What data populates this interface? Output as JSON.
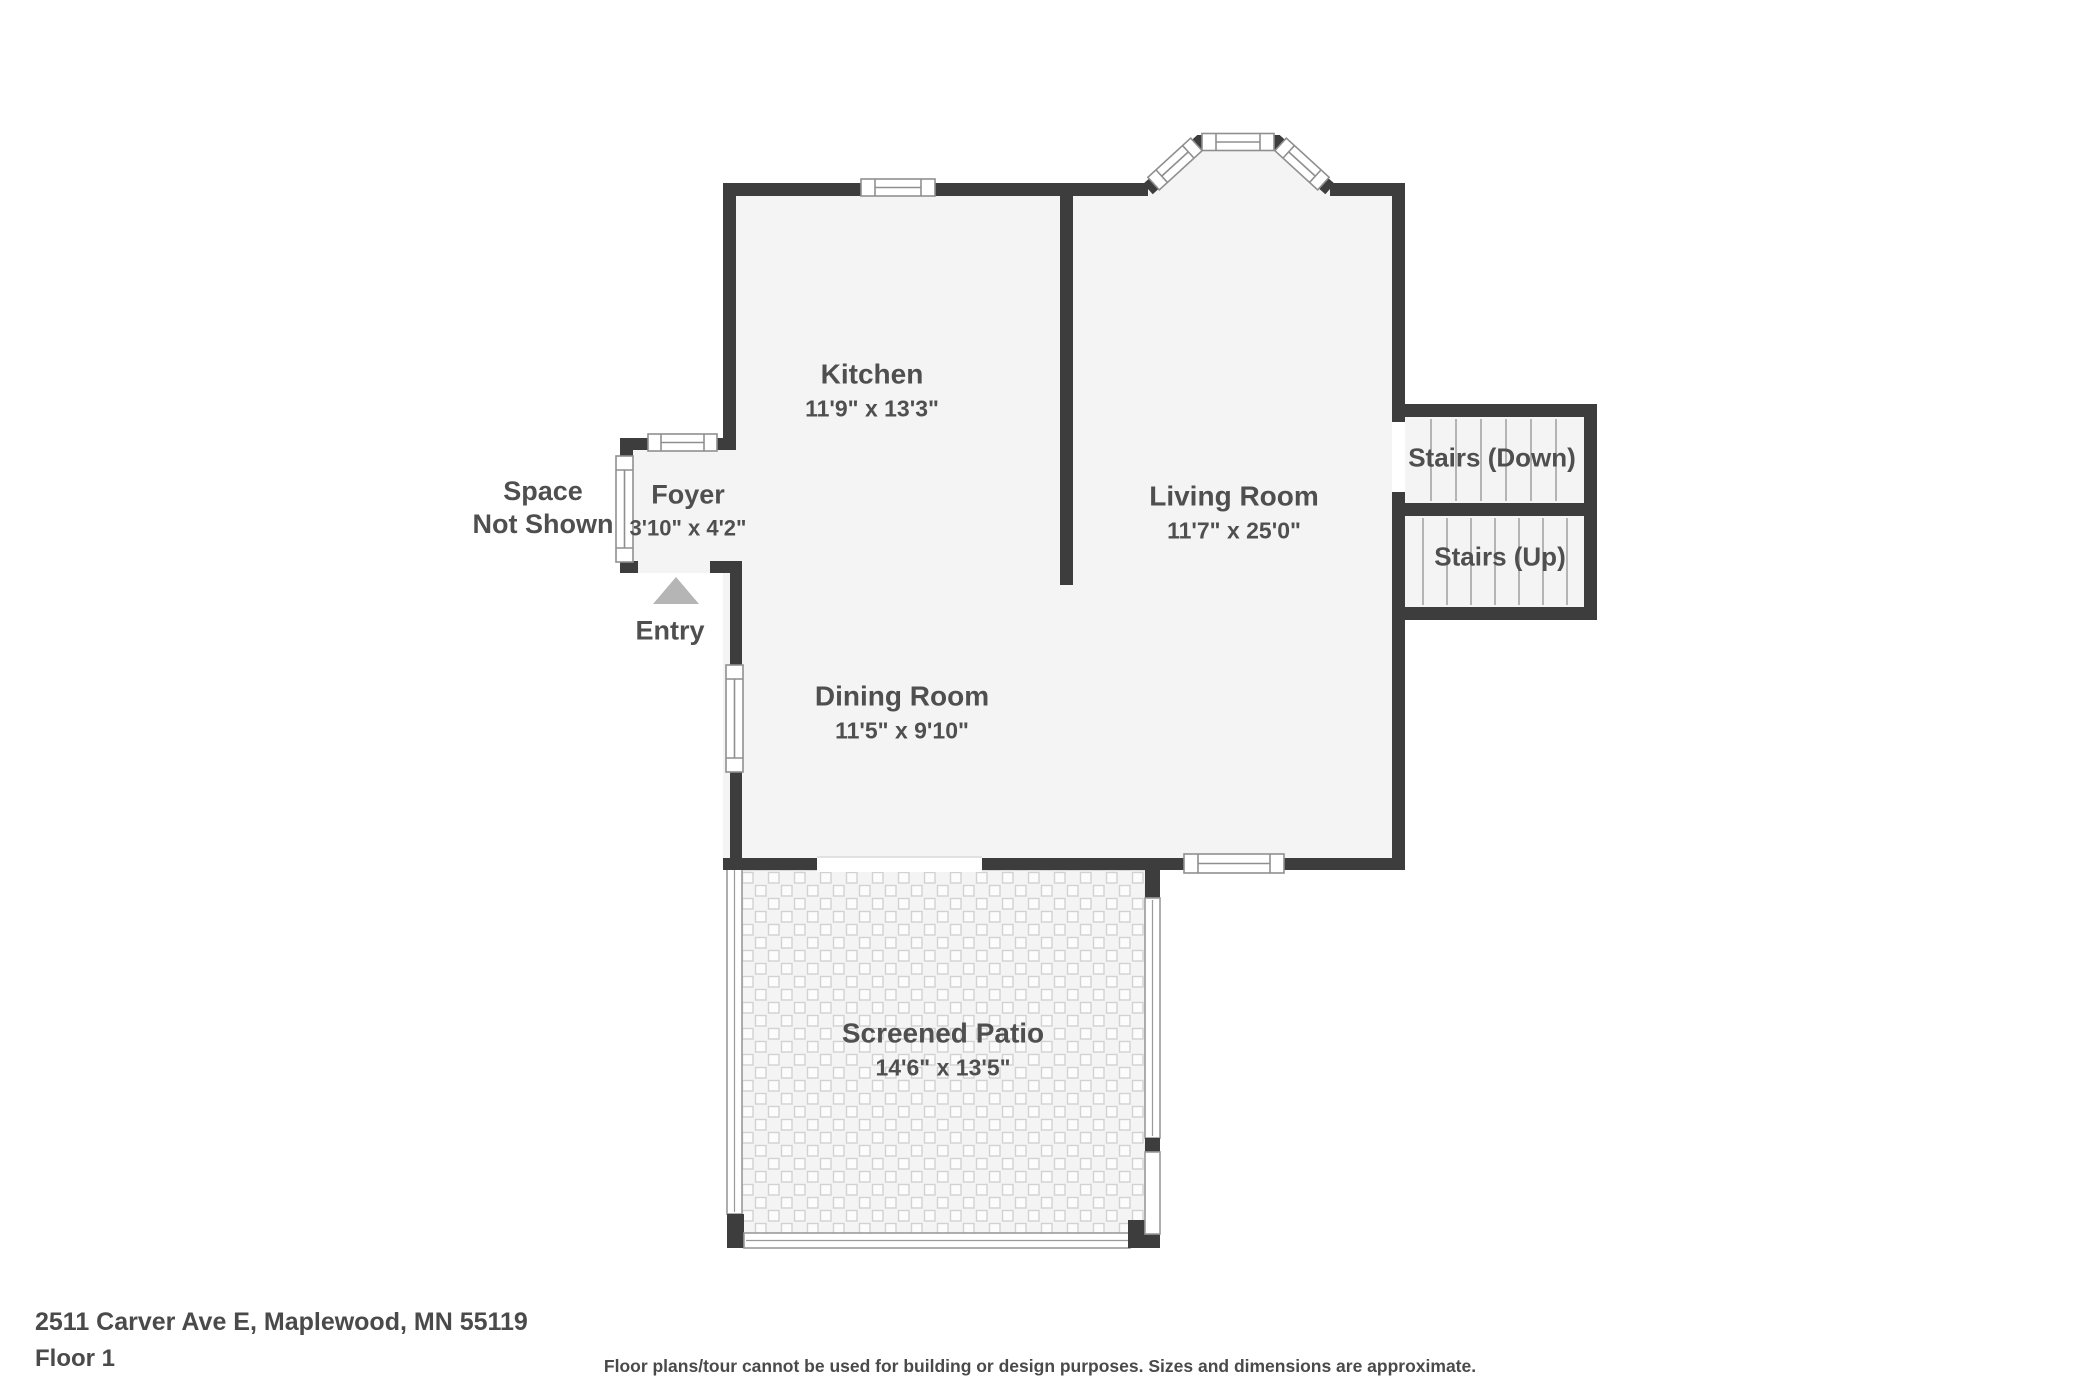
{
  "rooms": {
    "kitchen": {
      "name": "Kitchen",
      "dims": "11'9\" x 13'3\""
    },
    "living_room": {
      "name": "Living Room",
      "dims": "11'7\" x 25'0\""
    },
    "dining_room": {
      "name": "Dining Room",
      "dims": "11'5\" x 9'10\""
    },
    "foyer": {
      "name": "Foyer",
      "dims": "3'10\" x 4'2\""
    },
    "screened_patio": {
      "name": "Screened Patio",
      "dims": "14'6\" x 13'5\""
    }
  },
  "stairs": {
    "down_label": "Stairs (Down)",
    "up_label": "Stairs (Up)"
  },
  "annotations": {
    "space_not_shown_line1": "Space",
    "space_not_shown_line2": "Not Shown",
    "entry_label": "Entry"
  },
  "footer": {
    "address": "2511 Carver Ave E, Maplewood, MN 55119",
    "floor_label": "Floor 1",
    "disclaimer": "Floor plans/tour cannot be used for building or design purposes. Sizes and dimensions are approximate."
  },
  "colors": {
    "wall": "#3d3d3d",
    "room_fill": "#f4f4f4",
    "label": "#4f4f4f",
    "entry_arrow": "#b5b5b5"
  }
}
